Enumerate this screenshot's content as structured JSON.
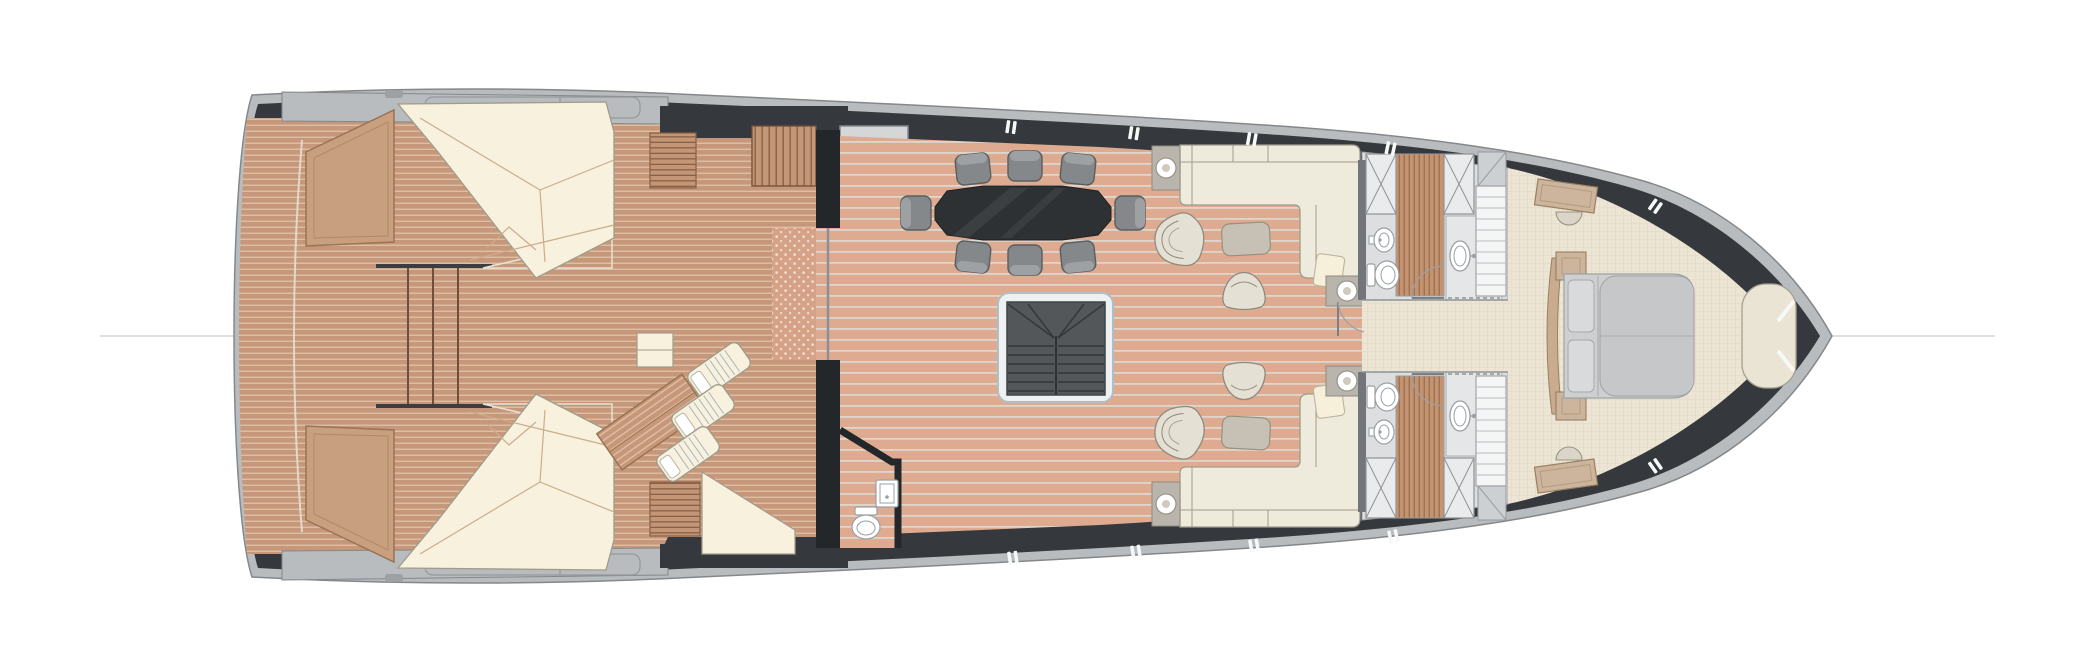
{
  "labels": {
    "fly_stairs": "fly"
  },
  "colors": {
    "hull_light": "#b9bcbe",
    "hull_rim_line": "#84888b",
    "hull_dark": "#35393d",
    "wall_dark": "#24272a",
    "teak_aft": "#c6977a",
    "teak_aft_line": "#e0c3a7",
    "teak_salon": "#dfab90",
    "teak_salon_line": "#ddd6cd",
    "slat_wood": "#c3946f",
    "slat_line": "#9c6f52",
    "stair_wood": "#c49678",
    "stair_wood_line": "#8a6044",
    "sunpad_cream": "#f7f1dd",
    "seam_tan": "#ccac8c",
    "wood_trim": "#c9a07f",
    "wood_trim_edge": "#9a7354",
    "upholstery_cream": "#efebdc",
    "upholstery_edge": "#a19b8b",
    "dining_table": "#2e3133",
    "chair_grey": "#84888b",
    "chair_edge": "#5a5e61",
    "chair_band": "#9da1a4",
    "stairwell_dark": "#53575a",
    "stairwell_line": "#33373a",
    "stair_frame": "#eef1f2",
    "stair_frame_edge": "#aebfc7",
    "bathroom_floor": "#dcdee0",
    "fixture_white": "#ffffff",
    "fixture_edge": "#9aa0a3",
    "cabinet_grey": "#cdd0d2",
    "carpet_cream": "#ece5d3",
    "carpet_line": "#e0d8c4",
    "bed_grey": "#cdcfd1",
    "duvet_grey": "#c5c7c9",
    "bed_line": "#9fa2a5",
    "furniture_taupe": "#c7c0b4",
    "sidetable_grey": "#b9b5ac",
    "label_grey": "#8b8e91",
    "centerline_grey": "#d4d6d7",
    "mat_teak": "#d6a287",
    "mat_dot": "#f3ece1",
    "partition_grey": "#8f9396",
    "landing_grey": "#d4d6d7"
  },
  "inventory": {
    "sun_pads": 2,
    "sun_loungers": 3,
    "deck_tables": 2,
    "dining_chairs": 8,
    "dining_tables": 1,
    "sofas": 2,
    "armchairs": 2,
    "tub_chairs": 2,
    "ottomans": 2,
    "table_lamps": 4,
    "bathrooms": 2,
    "day_heads": 1,
    "toilets": 3,
    "bidets": 2,
    "sinks": 3,
    "showers": 2,
    "double_beds": 1,
    "bow_sofas": 1,
    "dressers": 2,
    "staircases": 5
  }
}
